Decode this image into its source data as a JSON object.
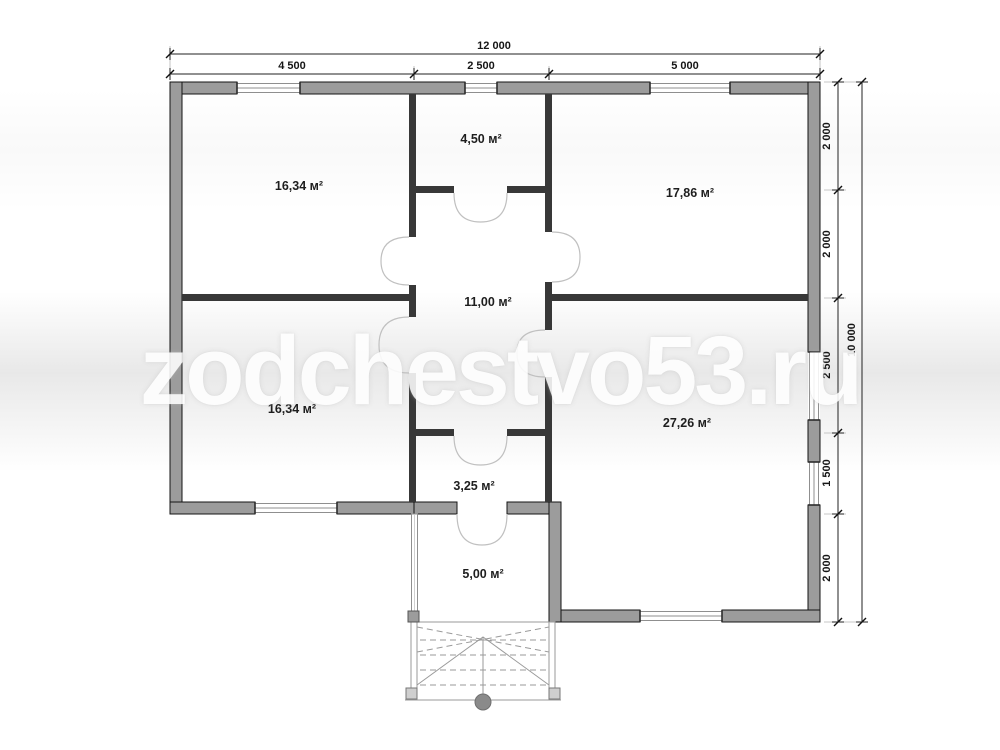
{
  "watermark": "zodchestvo53.ru",
  "dimensions": {
    "top_total": "12 000",
    "top_segments": [
      "4 500",
      "2 500",
      "5 000"
    ],
    "right_segments": [
      "2 000",
      "2 000",
      "2 500",
      "1 500",
      "2 000"
    ],
    "right_total": "10 000"
  },
  "rooms": [
    {
      "name": "room-top-left",
      "area": "16,34 м²"
    },
    {
      "name": "room-top-center",
      "area": "4,50 м²"
    },
    {
      "name": "room-top-right",
      "area": "17,86 м²"
    },
    {
      "name": "hall-center",
      "area": "11,00 м²"
    },
    {
      "name": "room-bottom-left",
      "area": "16,34 м²"
    },
    {
      "name": "room-bottom-right",
      "area": "27,26 м²"
    },
    {
      "name": "room-wc",
      "area": "3,25 м²"
    },
    {
      "name": "vestibule",
      "area": "5,00 м²"
    }
  ],
  "colors": {
    "exterior_wall_fill": "#9c9c9c",
    "wall_edge": "#141414",
    "interior_wall": "#383838",
    "dimension_text": "#161616",
    "door_arc": "#c0c0c0",
    "watermark": "#ffffff"
  }
}
